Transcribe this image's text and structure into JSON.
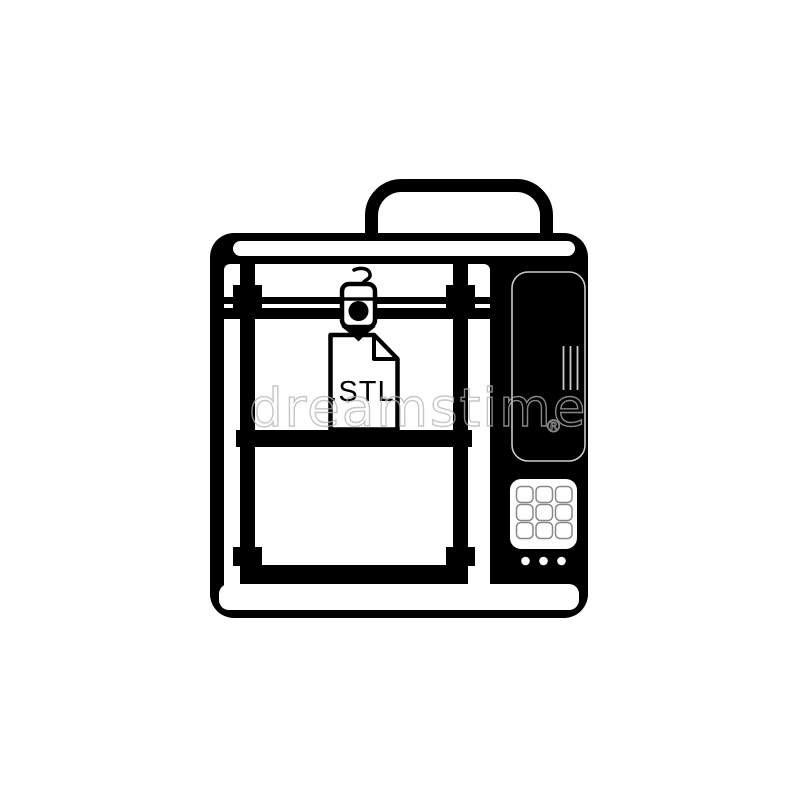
{
  "icon": {
    "file_label": ".STL",
    "ink_color": "#000000",
    "paper_color": "#ffffff",
    "detail_line_color": "#cbcbcb",
    "key_outline_color": "#888888"
  },
  "watermark": {
    "text": "dreamstime",
    "registered_mark": "®",
    "color": "#b3b3b3"
  }
}
